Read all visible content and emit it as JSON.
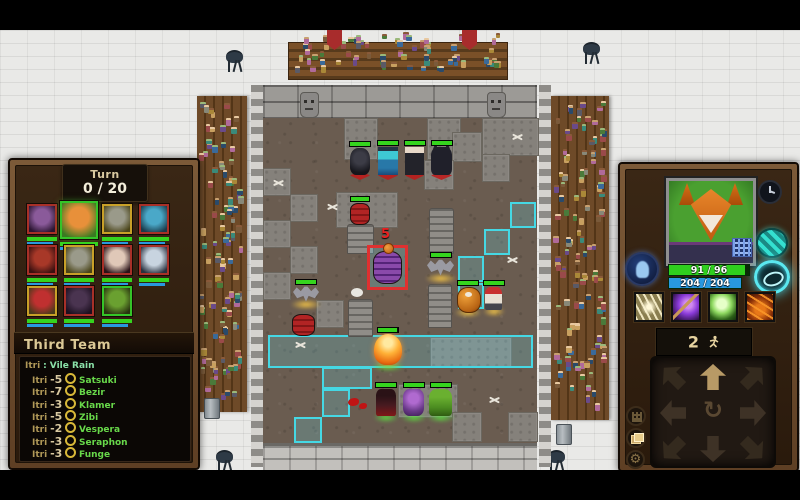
{
  "left_panel": {
    "turn": {
      "label": "Turn",
      "value": "0 / 20"
    },
    "team_title": "Third Team",
    "log_header": {
      "source": "Itri",
      "separator": ":",
      "event": "Vile Rain"
    },
    "log_entries": [
      {
        "source": "Itri",
        "amount": "-5",
        "target": "Satsuki"
      },
      {
        "source": "Itri",
        "amount": "-7",
        "target": "Bezir"
      },
      {
        "source": "Itri",
        "amount": "-3",
        "target": "Klamer"
      },
      {
        "source": "Itri",
        "amount": "-5",
        "target": "Zibi"
      },
      {
        "source": "Itri",
        "amount": "-2",
        "target": "Vespera"
      },
      {
        "source": "Itri",
        "amount": "-3",
        "target": "Seraphon"
      },
      {
        "source": "Itri",
        "amount": "-3",
        "target": "Funge"
      }
    ],
    "roster": [
      {
        "id": "imp",
        "border": "#a83028",
        "bg": "#2a1430",
        "fg": "#8a5a9a",
        "selected": false
      },
      {
        "id": "fox",
        "border": "#35c428",
        "bg": "#3a7a22",
        "fg": "#e8903a",
        "selected": true
      },
      {
        "id": "bat",
        "border": "#c8a028",
        "bg": "#4a4418",
        "fg": "#9a9a8a",
        "selected": false
      },
      {
        "id": "siren",
        "border": "#a83028",
        "bg": "#1a3a4a",
        "fg": "#4aa8c8",
        "selected": false
      },
      {
        "id": "demon",
        "border": "#a83028",
        "bg": "#3a1010",
        "fg": "#a83828",
        "selected": false
      },
      {
        "id": "bat-2",
        "border": "#c8a028",
        "bg": "#4a4418",
        "fg": "#9a9a8a",
        "selected": false
      },
      {
        "id": "vampire",
        "border": "#a83028",
        "bg": "#2a1218",
        "fg": "#e0c8b8",
        "selected": false
      },
      {
        "id": "yeti",
        "border": "#a83028",
        "bg": "#28303e",
        "fg": "#c8d4e0",
        "selected": false
      },
      {
        "id": "mushroom",
        "border": "#c8a028",
        "bg": "#4a3a1a",
        "fg": "#c03030",
        "selected": false
      },
      {
        "id": "shade",
        "border": "#a83028",
        "bg": "#1c1020",
        "fg": "#4a3450",
        "selected": false
      },
      {
        "id": "orc",
        "border": "#35c428",
        "bg": "#28320f",
        "fg": "#6aa030",
        "selected": false
      }
    ]
  },
  "right_panel": {
    "hp_text": "91 / 96",
    "mana_text": "204 / 204",
    "hp_fill_pct": 95,
    "mana_fill_pct": 100,
    "move_points": "2",
    "colors": {
      "hp": "#2fd01e",
      "mana": "#2898e0",
      "accent": "#4ad8e8"
    }
  },
  "arena": {
    "damage_preview": "5",
    "highlight_color": "#45d8e4",
    "stone_tiles": [
      [
        344,
        118,
        32,
        40
      ],
      [
        427,
        118,
        32,
        40
      ],
      [
        482,
        118,
        55,
        36
      ],
      [
        452,
        132,
        28,
        28
      ],
      [
        424,
        160,
        28,
        28
      ],
      [
        482,
        154,
        26,
        26
      ],
      [
        263,
        168,
        26,
        26
      ],
      [
        290,
        194,
        26,
        26
      ],
      [
        263,
        220,
        26,
        26
      ],
      [
        290,
        246,
        26,
        26
      ],
      [
        263,
        272,
        26,
        26
      ],
      [
        316,
        300,
        26,
        26
      ],
      [
        336,
        192,
        60,
        34
      ],
      [
        430,
        337,
        80,
        29
      ],
      [
        398,
        384,
        58,
        32
      ],
      [
        452,
        412,
        28,
        28
      ],
      [
        508,
        412,
        28,
        28
      ]
    ],
    "highlight": {
      "band": [
        268,
        335,
        265,
        33
      ],
      "tiles": [
        [
          510,
          202,
          26,
          26
        ],
        [
          484,
          229,
          26,
          26
        ],
        [
          458,
          256,
          26,
          26
        ],
        [
          458,
          283,
          26,
          26
        ],
        [
          322,
          367,
          50,
          22
        ],
        [
          322,
          389,
          28,
          28
        ],
        [
          294,
          417,
          28,
          26
        ]
      ]
    },
    "units": [
      {
        "id": "shade-enemy",
        "sprite": "shade",
        "team": "enemy",
        "x": 350,
        "y": 148,
        "w": 20,
        "h": 27,
        "hp": 100
      },
      {
        "id": "blue-warrior-enemy",
        "sprite": "bluewarrior",
        "team": "enemy",
        "x": 378,
        "y": 147,
        "w": 20,
        "h": 28,
        "hp": 100
      },
      {
        "id": "pale-rogue-enemy",
        "sprite": "palerogue",
        "team": "enemy",
        "x": 405,
        "y": 147,
        "w": 19,
        "h": 28,
        "hp": 100
      },
      {
        "id": "black-cat-enemy",
        "sprite": "blackcat",
        "team": "enemy",
        "x": 431,
        "y": 147,
        "w": 21,
        "h": 28,
        "hp": 100
      },
      {
        "id": "bat-west",
        "sprite": "bat",
        "team": "neutral",
        "x": 293,
        "y": 286,
        "w": 26,
        "h": 17,
        "hp": 100
      },
      {
        "id": "bat-east",
        "sprite": "bat",
        "team": "neutral",
        "x": 427,
        "y": 259,
        "w": 27,
        "h": 18,
        "hp": 100
      },
      {
        "id": "pumpkin-keg",
        "sprite": "pumpkin",
        "team": "neutral",
        "x": 457,
        "y": 287,
        "w": 22,
        "h": 24,
        "hp": 100
      },
      {
        "id": "red-bandit",
        "sprite": "redcap",
        "team": "neutral",
        "x": 485,
        "y": 287,
        "w": 17,
        "h": 23,
        "hp": 100
      },
      {
        "id": "fox-hero",
        "sprite": "fox",
        "team": "ally",
        "x": 374,
        "y": 334,
        "w": 28,
        "h": 31,
        "hp": 95
      },
      {
        "id": "assassin-ally",
        "sprite": "assassin",
        "team": "ally",
        "x": 376,
        "y": 389,
        "w": 20,
        "h": 27,
        "hp": 100
      },
      {
        "id": "mage-ally",
        "sprite": "purplemage",
        "team": "ally",
        "x": 403,
        "y": 389,
        "w": 21,
        "h": 27,
        "hp": 100
      },
      {
        "id": "orc-ally",
        "sprite": "orc",
        "team": "ally",
        "x": 429,
        "y": 389,
        "w": 23,
        "h": 27,
        "hp": 100
      }
    ],
    "decor": [
      {
        "type": "tombstone",
        "x": 429,
        "y": 208,
        "w": 23,
        "h": 44
      },
      {
        "type": "tombstone",
        "x": 428,
        "y": 284,
        "w": 22,
        "h": 42
      },
      {
        "type": "tombstone",
        "x": 348,
        "y": 299,
        "w": 23,
        "h": 36
      },
      {
        "type": "column",
        "x": 347,
        "y": 224,
        "w": 25,
        "h": 28
      },
      {
        "type": "barrel-red",
        "x": 350,
        "y": 203,
        "w": 20,
        "h": 22,
        "hp": 100
      },
      {
        "type": "barrel-red",
        "x": 292,
        "y": 314,
        "w": 23,
        "h": 22
      },
      {
        "type": "barrel-purple",
        "x": 373,
        "y": 251,
        "w": 29,
        "h": 33,
        "selected": true
      },
      {
        "type": "bone",
        "x": 272,
        "y": 178
      },
      {
        "type": "bone",
        "x": 326,
        "y": 202
      },
      {
        "type": "bone",
        "x": 511,
        "y": 132
      },
      {
        "type": "bone",
        "x": 506,
        "y": 255
      },
      {
        "type": "bone",
        "x": 294,
        "y": 340
      },
      {
        "type": "bone",
        "x": 488,
        "y": 395
      },
      {
        "type": "bubble",
        "x": 351,
        "y": 288
      },
      {
        "type": "splat",
        "x": 348,
        "y": 398,
        "w": 11,
        "h": 8
      },
      {
        "type": "splat",
        "x": 359,
        "y": 403,
        "w": 8,
        "h": 6
      }
    ],
    "gargoyles": [
      [
        300,
        92
      ],
      [
        487,
        92
      ]
    ],
    "banners": [
      [
        327,
        24
      ],
      [
        462,
        24
      ]
    ],
    "grills": [
      [
        226,
        46
      ],
      [
        583,
        38
      ],
      [
        216,
        446
      ],
      [
        548,
        446
      ]
    ],
    "bins": [
      [
        204,
        398
      ],
      [
        556,
        424
      ]
    ]
  }
}
